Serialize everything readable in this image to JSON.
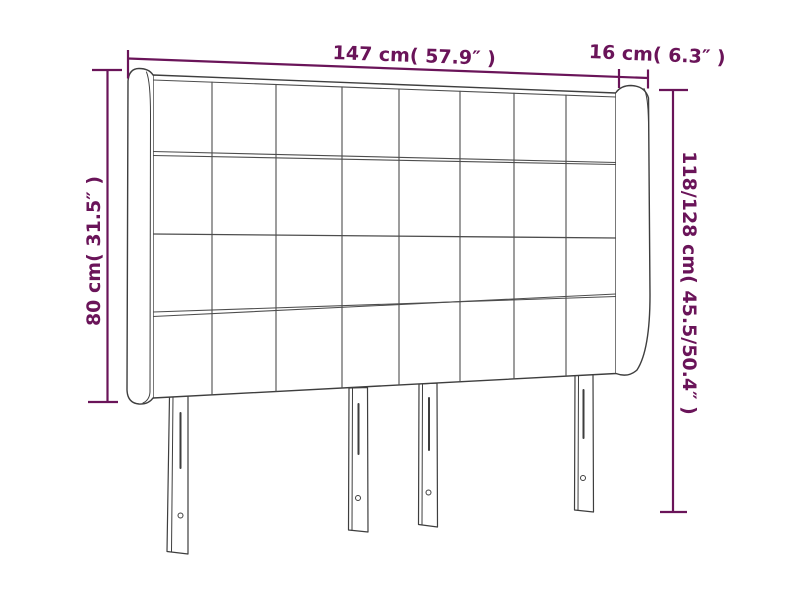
{
  "diagram": {
    "labels": {
      "total_width": "147 cm( 57.9″ )",
      "wing_width": "16 cm( 6.3″ )",
      "left_height": "80 cm( 31.5″ )",
      "right_height": "118/128 cm( 45.5/50.4″ )"
    },
    "colors": {
      "dimension_accent": "#6a1459",
      "outline": "#3e3e3e",
      "seam": "#4d4d4d",
      "background": "#ffffff"
    }
  }
}
